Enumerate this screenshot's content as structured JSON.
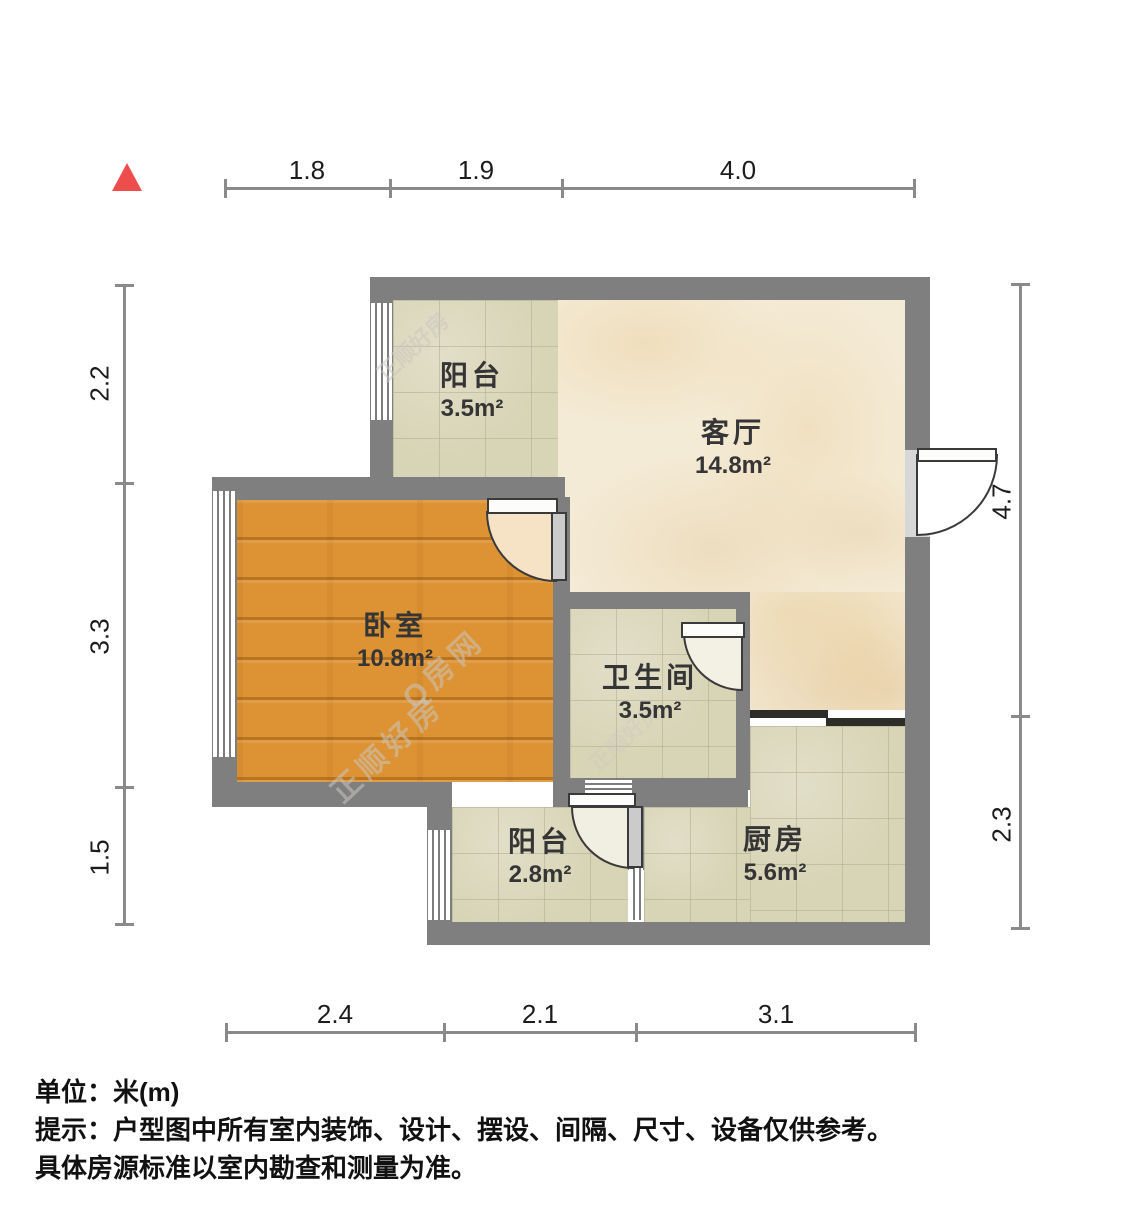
{
  "rooms": {
    "balcony_top": {
      "name": "阳台",
      "area": "3.5m²"
    },
    "living": {
      "name": "客厅",
      "area": "14.8m²"
    },
    "bedroom": {
      "name": "卧室",
      "area": "10.8m²"
    },
    "bathroom": {
      "name": "卫生间",
      "area": "3.5m²"
    },
    "kitchen": {
      "name": "厨房",
      "area": "5.6m²"
    },
    "balcony_bottom": {
      "name": "阳台",
      "area": "2.8m²"
    }
  },
  "dimensions": {
    "top": [
      "1.8",
      "1.9",
      "4.0"
    ],
    "bottom": [
      "2.4",
      "2.1",
      "3.1"
    ],
    "left": [
      "2.2",
      "3.3",
      "1.5"
    ],
    "right": [
      "4.7",
      "2.3"
    ]
  },
  "watermarks": {
    "brand": "正顺好房",
    "site": "Q房网"
  },
  "footer": {
    "unit": "单位：米(m)",
    "tip1": "提示：户型图中所有室内装饰、设计、摆设、间隔、尺寸、设备仅供参考。",
    "tip2": "具体房源标准以室内勘查和测量为准。"
  },
  "colors": {
    "wall": "#7f7f7f",
    "wood_floor": "#dd9334",
    "tile_floor": "#d8d4b6",
    "marble_floor": "#f4ebd6",
    "north_marker": "#ee4d4d",
    "dimension_line": "#8a8a8a",
    "slider_dark": "#2e2c28"
  }
}
